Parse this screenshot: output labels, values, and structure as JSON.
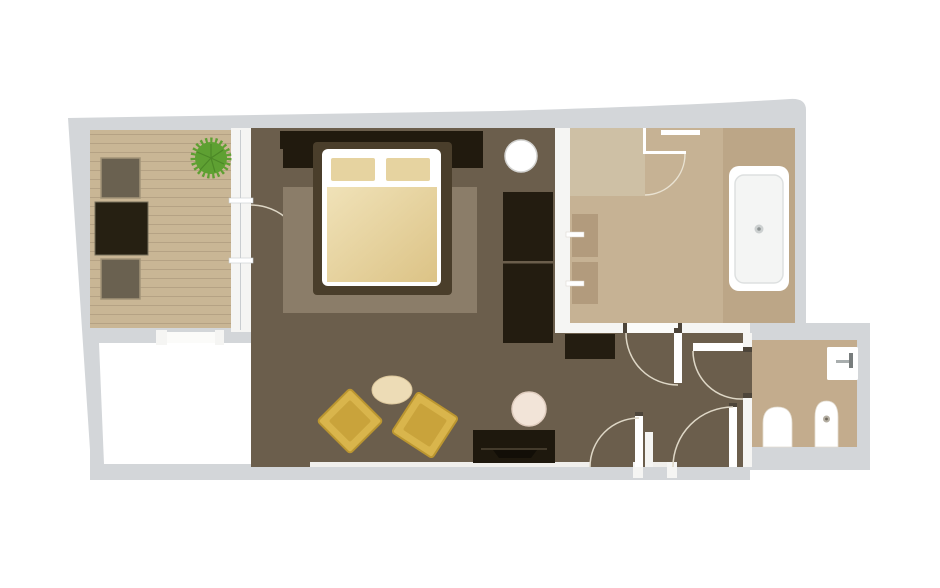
{
  "meta": {
    "kind": "floor-plan",
    "rooms": [
      "balcony-deck",
      "terrace-court",
      "bedroom",
      "living-area",
      "hallway",
      "bathroom",
      "wc"
    ]
  },
  "colors": {
    "background": "#ffffff",
    "wall_outer": "#d3d6d9",
    "interior_wall": "#f5f5f3",
    "opening_white": "#fbfbf9",
    "jamb_dark": "#4d453a",
    "door_arc": "#ded7c6",
    "deck": "#c9b695",
    "deck_plank_line": "#b5a284",
    "deck_chair": "#6a6150",
    "deck_chair_edge": "#a29478",
    "deck_table": "#262012",
    "deck_table_edge": "#77705c",
    "plant": "#5ea032",
    "plant_dark": "#4c8827",
    "white_room": "#ffffff",
    "floor_dark": "#6b5e4c",
    "rug": "#8b7d69",
    "headboard": "#211a0e",
    "bed_frame_dark": "#4a3e2b",
    "bed_frame_white": "#ffffff",
    "pillow": "#e6d3a0",
    "bedding_light": "#f0e2b8",
    "bedding_deep": "#dcc386",
    "wardrobe": "#231c10",
    "wardrobe_seam": "#6b5e4c",
    "round_table": "#ffffff",
    "round_table_edge": "#d3d3d1",
    "oval_table": "#eddcb6",
    "oval_table_edge": "#dcc79c",
    "stool": "#f2e4d8",
    "stool_edge": "#e0cdbf",
    "chair_gold": "#d9b54c",
    "chair_gold_inner": "#c9a33b",
    "chair_gold_edge": "#bb9630",
    "desk": "#1e180d",
    "desk_handle": "#443b2c",
    "desk_notch": "#120e07",
    "bench": "#241d11",
    "bathroom_floor": "#c6b294",
    "shower_zone": "#cec0a5",
    "tub_recess": "#bca687",
    "vanity": "#b29b7d",
    "tub_white": "#ffffff",
    "tub_inner": "#f4f5f4",
    "tub_inner_edge": "#dde0e0",
    "drain": "#ccd0d0",
    "drain_dot": "#8c9292",
    "wc_floor": "#c3ac8d",
    "fixture_white": "#ffffff",
    "fixture_edge": "#e3ddd1",
    "faucet_metal": "#a9aeae",
    "faucet_handle": "#787d7d",
    "bidet_drain": "#b4aea2",
    "bidet_drain_dot": "#6e675b"
  }
}
